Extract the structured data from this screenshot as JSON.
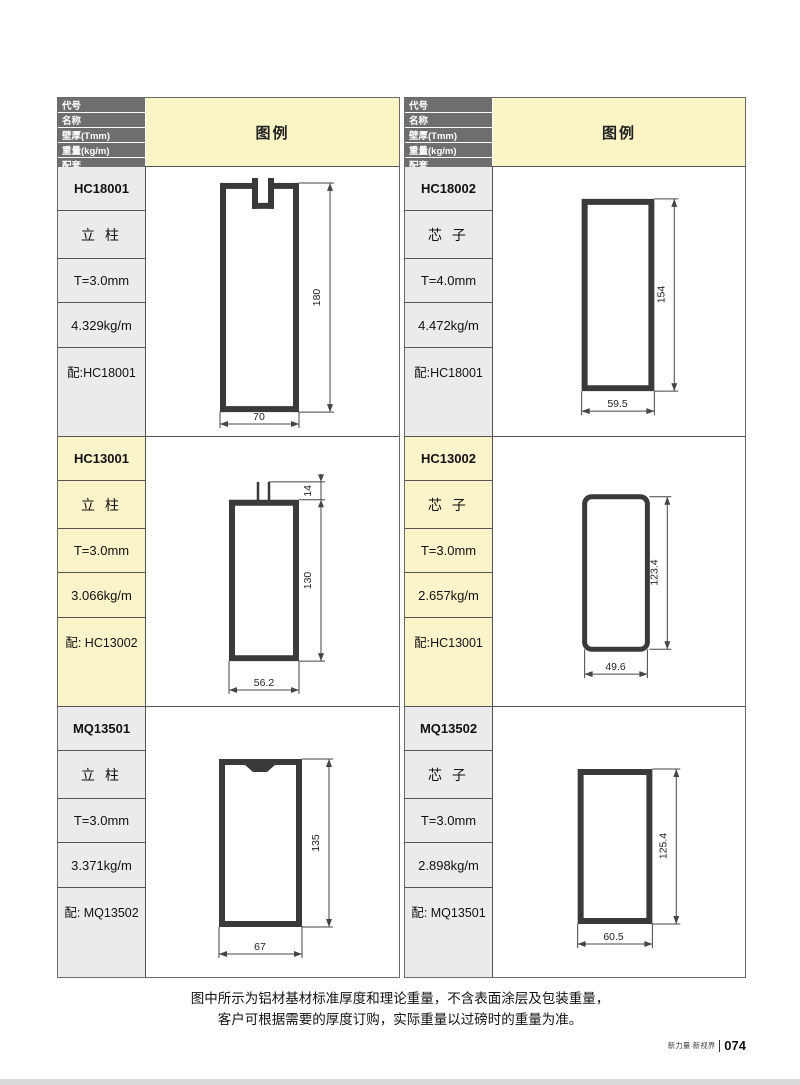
{
  "header": {
    "rows": [
      "代号",
      "名称",
      "壁厚(Tmm)",
      "重量(kg/m)",
      "配套"
    ],
    "legend_label": "图例"
  },
  "tables": {
    "left": {
      "entries": [
        {
          "code": "HC18001",
          "name": "立 柱",
          "thickness": "T=3.0mm",
          "weight": "4.329kg/m",
          "match": "配:HC18001",
          "dims": {
            "height": "180",
            "width": "70"
          }
        },
        {
          "code": "HC13001",
          "name": "立 柱",
          "thickness": "T=3.0mm",
          "weight": "3.066kg/m",
          "match": "配: HC13002",
          "dims": {
            "tab": "14",
            "height": "130",
            "width": "56.2"
          }
        },
        {
          "code": "MQ13501",
          "name": "立 柱",
          "thickness": "T=3.0mm",
          "weight": "3.371kg/m",
          "match": "配: MQ13502",
          "dims": {
            "height": "135",
            "width": "67"
          }
        }
      ]
    },
    "right": {
      "entries": [
        {
          "code": "HC18002",
          "name": "芯 子",
          "thickness": "T=4.0mm",
          "weight": "4.472kg/m",
          "match": "配:HC18001",
          "dims": {
            "height": "154",
            "width": "59.5"
          }
        },
        {
          "code": "HC13002",
          "name": "芯 子",
          "thickness": "T=3.0mm",
          "weight": "2.657kg/m",
          "match": "配:HC13001",
          "dims": {
            "height": "123.4",
            "width": "49.6"
          }
        },
        {
          "code": "MQ13502",
          "name": "芯 子",
          "thickness": "T=3.0mm",
          "weight": "2.898kg/m",
          "match": "配: MQ13501",
          "dims": {
            "height": "125.4",
            "width": "60.5"
          }
        }
      ]
    }
  },
  "footer": {
    "note_line1": "图中所示为铝材基材标准厚度和理论重量，不含表面涂层及包装重量，",
    "note_line2": "客户可根据需要的厚度订购，实际重量以过磅时的重量为准。",
    "brand": "新力量·新视界",
    "page_number": "074"
  },
  "colors": {
    "header_gray": "#6e6e6e",
    "legend_yellow": "#FBF4C4",
    "cell_gray": "#EBEBEB",
    "cell_yellow": "#FBF4CA",
    "profile_line": "#3a3a3a",
    "dimension_line": "#454545"
  }
}
